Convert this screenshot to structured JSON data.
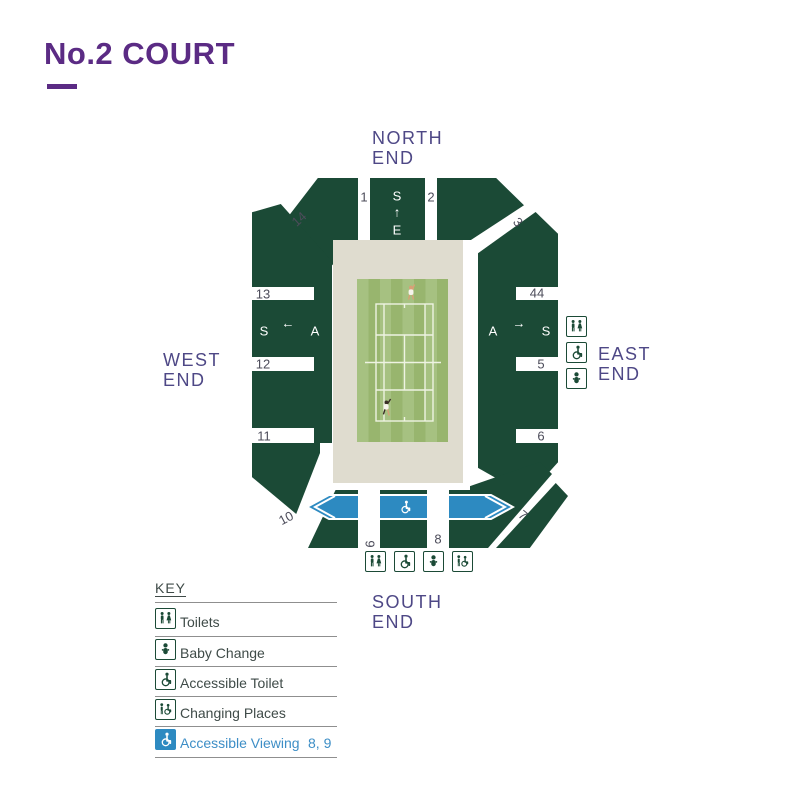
{
  "page": {
    "title": "No.2 COURT"
  },
  "ends": {
    "north": {
      "l1": "NORTH",
      "l2": "END"
    },
    "west": {
      "l1": "WEST",
      "l2": "END"
    },
    "east": {
      "l1": "EAST",
      "l2": "END"
    },
    "south": {
      "l1": "SOUTH",
      "l2": "END"
    }
  },
  "map": {
    "aisles": [
      {
        "id": "aisle-1",
        "label": "1"
      },
      {
        "id": "aisle-2",
        "label": "2"
      },
      {
        "id": "aisle-3",
        "label": "3"
      },
      {
        "id": "aisle-4",
        "label": "44"
      },
      {
        "id": "aisle-5",
        "label": "5"
      },
      {
        "id": "aisle-6",
        "label": "6"
      },
      {
        "id": "aisle-7",
        "label": "7"
      },
      {
        "id": "aisle-8",
        "label": "8"
      },
      {
        "id": "aisle-9",
        "label": "9"
      },
      {
        "id": "aisle-10",
        "label": "10"
      },
      {
        "id": "aisle-11",
        "label": "11"
      },
      {
        "id": "aisle-12",
        "label": "12"
      },
      {
        "id": "aisle-13",
        "label": "13"
      },
      {
        "id": "aisle-14",
        "label": "14"
      }
    ],
    "letters": {
      "north": [
        "S",
        "↑",
        "E"
      ],
      "west": [
        "S",
        "←",
        "A"
      ],
      "east": [
        "A",
        "→",
        "S"
      ]
    },
    "facilities_east": [
      "toilets-icon",
      "accessible-toilet-icon",
      "baby-change-icon"
    ],
    "facilities_south": [
      "toilets-icon",
      "accessible-toilet-icon",
      "baby-change-icon",
      "changing-places-icon"
    ],
    "accessible_viewing_strip": "wheelchair-icon"
  },
  "key": {
    "heading": "KEY",
    "rows": [
      {
        "icon": "toilets-icon",
        "label": "Toilets"
      },
      {
        "icon": "baby-change-icon",
        "label": "Baby Change"
      },
      {
        "icon": "accessible-toilet-icon",
        "label": "Accessible Toilet"
      },
      {
        "icon": "changing-places-icon",
        "label": "Changing Places"
      },
      {
        "icon": "accessible-viewing-icon",
        "label": "Accessible Viewing",
        "sections": "8, 9"
      }
    ]
  },
  "colors": {
    "brand_purple": "#5b2b84",
    "end_label_purple": "#4e4886",
    "stand_green": "#1b4a36",
    "lawn_light": "#a6c181",
    "lawn_dark": "#98b56e",
    "surround_beige": "#dfdccf",
    "accessible_blue": "#2d8ac1",
    "key_text": "#3f4b48",
    "key_link_blue": "#3d8ec6",
    "aisle_number": "#4c4c5a"
  }
}
